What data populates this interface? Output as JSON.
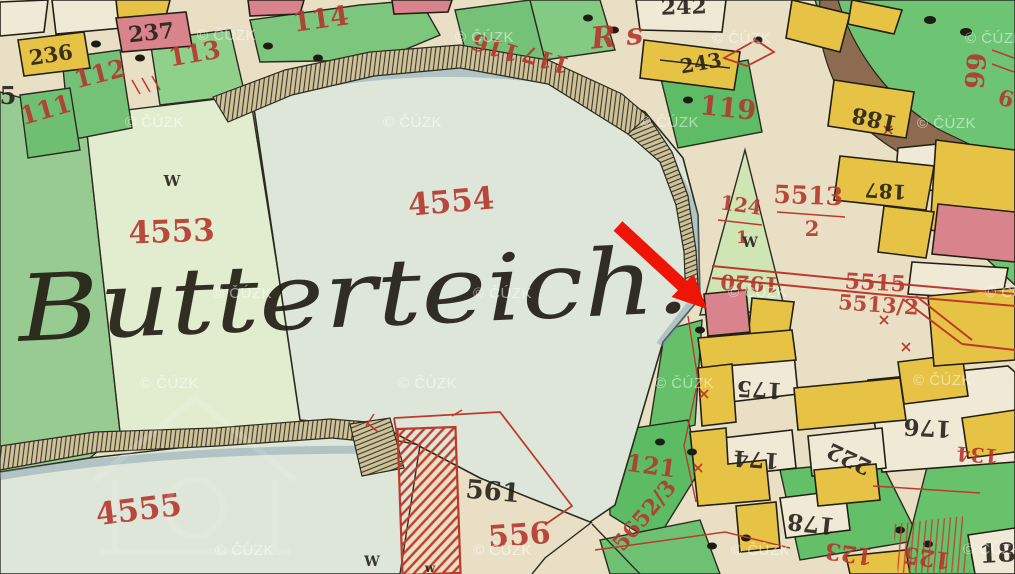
{
  "map": {
    "place_name": "Butterteich.",
    "colors": {
      "red_ink": "#b5372e",
      "black_ink": "#26221a",
      "arrow": "#ee1408",
      "watermark": "#ffffff",
      "pond": "#dde6d8",
      "field_green": "#74c277",
      "dark_green": "#97cb92",
      "pale_field": "#e2edcf",
      "building_yellow": "#e6c345",
      "building_pink": "#d9838d",
      "building_white": "#efe9d6",
      "road_brown": "#8d6b50",
      "dam_tan": "#cec29b",
      "parchment": "#e8dfc4"
    },
    "labels_red": [
      {
        "text": "114",
        "x": 322,
        "y": 28,
        "size": 27,
        "rot": -8
      },
      {
        "text": "113",
        "x": 196,
        "y": 62,
        "size": 25,
        "rot": -10
      },
      {
        "text": "112",
        "x": 102,
        "y": 82,
        "size": 25,
        "rot": -14
      },
      {
        "text": "111",
        "x": 48,
        "y": 118,
        "size": 25,
        "rot": -16
      },
      {
        "text": "116",
        "x": 498,
        "y": 40,
        "size": 23,
        "rot": 197
      },
      {
        "text": "117",
        "x": 548,
        "y": 52,
        "size": 23,
        "rot": 197
      },
      {
        "text": "R s",
        "x": 618,
        "y": 46,
        "size": 30,
        "rot": -6,
        "script": true
      },
      {
        "text": "119",
        "x": 727,
        "y": 117,
        "size": 27,
        "rot": 6
      },
      {
        "text": "4553",
        "x": 172,
        "y": 242,
        "size": 31,
        "rot": -2
      },
      {
        "text": "4554",
        "x": 452,
        "y": 212,
        "size": 31,
        "rot": -5
      },
      {
        "text": "4555",
        "x": 140,
        "y": 520,
        "size": 31,
        "rot": -7
      },
      {
        "text": "5513",
        "x": 808,
        "y": 204,
        "size": 25,
        "rot": 2
      },
      {
        "text": "2",
        "x": 812,
        "y": 236,
        "size": 21,
        "rot": 0
      },
      {
        "text": "124",
        "x": 740,
        "y": 212,
        "size": 20,
        "rot": 8
      },
      {
        "text": "1",
        "x": 742,
        "y": 243,
        "size": 17,
        "rot": 0
      },
      {
        "text": "1920",
        "x": 750,
        "y": 276,
        "size": 21,
        "rot": 183
      },
      {
        "text": "5515",
        "x": 875,
        "y": 290,
        "size": 22,
        "rot": 3
      },
      {
        "text": "5513/2",
        "x": 878,
        "y": 312,
        "size": 21,
        "rot": 4
      },
      {
        "text": "121",
        "x": 650,
        "y": 474,
        "size": 24,
        "rot": 8
      },
      {
        "text": "5652/3",
        "x": 650,
        "y": 520,
        "size": 22,
        "rot": -50
      },
      {
        "text": "556",
        "x": 520,
        "y": 545,
        "size": 30,
        "rot": -4
      },
      {
        "text": "123",
        "x": 850,
        "y": 546,
        "size": 23,
        "rot": 188
      },
      {
        "text": "125",
        "x": 928,
        "y": 550,
        "size": 23,
        "rot": 188
      },
      {
        "text": "134",
        "x": 978,
        "y": 448,
        "size": 20,
        "rot": 184
      },
      {
        "text": "66",
        "x": 966,
        "y": 70,
        "size": 26,
        "rot": 95
      },
      {
        "text": "6",
        "x": 1004,
        "y": 106,
        "size": 22,
        "rot": 15
      }
    ],
    "labels_black": [
      {
        "text": "236",
        "x": 52,
        "y": 62,
        "size": 21,
        "rot": -9
      },
      {
        "text": "237",
        "x": 152,
        "y": 40,
        "size": 22,
        "rot": -6
      },
      {
        "text": "242",
        "x": 684,
        "y": 14,
        "size": 22,
        "rot": -2
      },
      {
        "text": "243",
        "x": 702,
        "y": 70,
        "size": 20,
        "rot": -10
      },
      {
        "text": "188",
        "x": 876,
        "y": 112,
        "size": 22,
        "rot": 192
      },
      {
        "text": "187",
        "x": 886,
        "y": 184,
        "size": 20,
        "rot": 183
      },
      {
        "text": "175",
        "x": 760,
        "y": 382,
        "size": 22,
        "rot": 183
      },
      {
        "text": "176",
        "x": 928,
        "y": 420,
        "size": 23,
        "rot": 183
      },
      {
        "text": "174",
        "x": 757,
        "y": 452,
        "size": 22,
        "rot": 184
      },
      {
        "text": "222",
        "x": 852,
        "y": 452,
        "size": 22,
        "rot": 205
      },
      {
        "text": "178",
        "x": 812,
        "y": 516,
        "size": 23,
        "rot": 186
      },
      {
        "text": "561",
        "x": 492,
        "y": 500,
        "size": 26,
        "rot": 5
      },
      {
        "text": "18",
        "x": 998,
        "y": 562,
        "size": 26,
        "rot": -3
      },
      {
        "text": "5",
        "x": 8,
        "y": 104,
        "size": 24,
        "rot": 0
      },
      {
        "text": "W",
        "x": 172,
        "y": 186,
        "size": 15,
        "rot": 0
      },
      {
        "text": "W",
        "x": 750,
        "y": 247,
        "size": 14,
        "rot": 0
      },
      {
        "text": "W",
        "x": 372,
        "y": 566,
        "size": 14,
        "rot": 0
      },
      {
        "text": "w",
        "x": 430,
        "y": 572,
        "size": 12,
        "rot": 0
      }
    ]
  },
  "watermark": {
    "text": "© ČÚZK",
    "positions": [
      [
        197,
        40
      ],
      [
        455,
        42
      ],
      [
        712,
        43
      ],
      [
        965,
        43
      ],
      [
        125,
        127
      ],
      [
        383,
        127
      ],
      [
        640,
        127
      ],
      [
        917,
        128
      ],
      [
        213,
        298
      ],
      [
        473,
        298
      ],
      [
        728,
        297
      ],
      [
        985,
        297
      ],
      [
        140,
        388
      ],
      [
        398,
        388
      ],
      [
        655,
        388
      ],
      [
        913,
        385
      ],
      [
        215,
        555
      ],
      [
        473,
        555
      ],
      [
        731,
        555
      ],
      [
        963,
        554
      ]
    ]
  },
  "annotation": {
    "arrow_color": "#ee1408"
  }
}
